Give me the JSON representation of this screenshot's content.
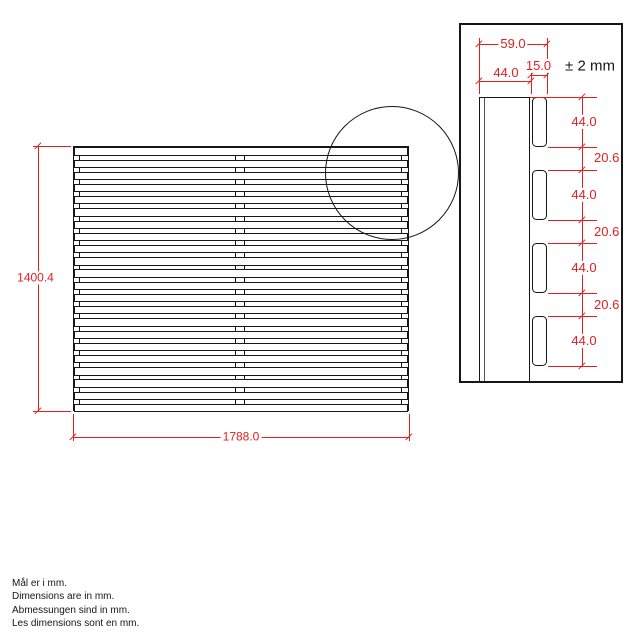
{
  "main_view": {
    "width_dim": "1788.0",
    "height_dim": "1400.4",
    "slat_count": 22
  },
  "detail_view": {
    "dim_overall_depth": "59.0",
    "dim_rail_depth": "44.0",
    "dim_slat_depth": "15.0",
    "tolerance": "± 2 mm",
    "side_dims": [
      {
        "label": "44.0",
        "kind": "slat"
      },
      {
        "label": "20.6",
        "kind": "gap"
      },
      {
        "label": "44.0",
        "kind": "slat"
      },
      {
        "label": "20.6",
        "kind": "gap"
      },
      {
        "label": "44.0",
        "kind": "slat"
      },
      {
        "label": "20.6",
        "kind": "gap"
      },
      {
        "label": "44.0",
        "kind": "slat"
      }
    ]
  },
  "notes": [
    "Mål er i mm.",
    "Dimensions are in mm.",
    "Abmessungen sind in mm.",
    "Les dimensions sont en mm."
  ],
  "colors": {
    "dimension_red": "#e02020",
    "line_black": "#161616",
    "background": "#ffffff"
  }
}
